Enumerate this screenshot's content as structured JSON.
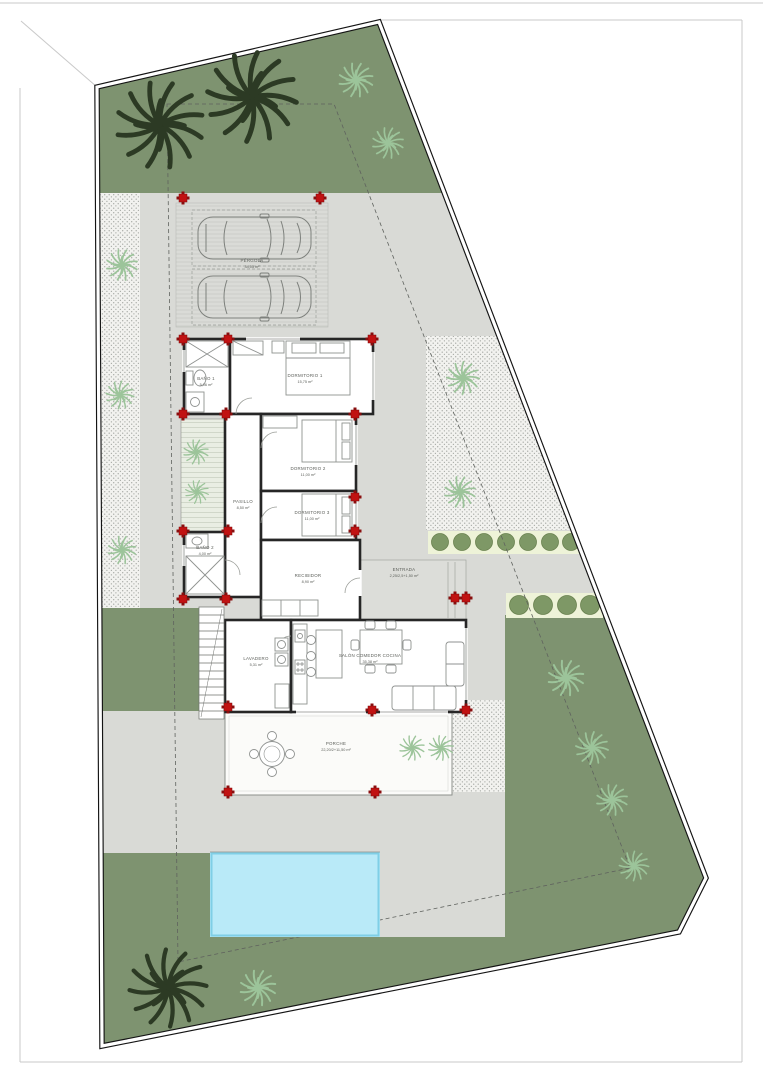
{
  "sheet": {
    "type_label": "site-plan"
  },
  "colors": {
    "paving": "#d9dad6",
    "paving_light": "#dcddd9",
    "lawn": "#7e9370",
    "deck": "#e9eee3",
    "hedge_strip": "#eef3d8",
    "bush": "#7e9866",
    "bush_edge": "#69814f",
    "pool_water": "#b9eaf8",
    "pool_edge": "#7fcfe6",
    "pillar_red": "#c11212",
    "boundary": "#141414",
    "wall": "#262626",
    "furniture": "#8f9290",
    "label": "#5b5e59",
    "palm_dark": "#2c3a24",
    "palm_light": "#9cc49a"
  },
  "rooms": [
    {
      "name": "PÉRGOLA",
      "area": "34,05 m²"
    },
    {
      "name": "BAÑO 1",
      "area": "5,06 m²"
    },
    {
      "name": "DORMITORIO 1",
      "area": "15,75 m²"
    },
    {
      "name": "DORMITORIO 2",
      "area": "11,00 m²"
    },
    {
      "name": "PASILLO",
      "area": "8,50 m²"
    },
    {
      "name": "DORMITORIO 3",
      "area": "11,00 m²"
    },
    {
      "name": "BAÑO 2",
      "area": "4,00 m²"
    },
    {
      "name": "RECIBIDOR",
      "area": "8,90 m²"
    },
    {
      "name": "ENTRADA",
      "area": "2,25/2,5+1,50 m²"
    },
    {
      "name": "LAVADERO",
      "area": "5,31 m²"
    },
    {
      "name": "SALÓN COMEDOR COCINA",
      "area": "35,38 m²"
    },
    {
      "name": "PORCHE",
      "area": "22,20/2+11,50 m²"
    }
  ]
}
